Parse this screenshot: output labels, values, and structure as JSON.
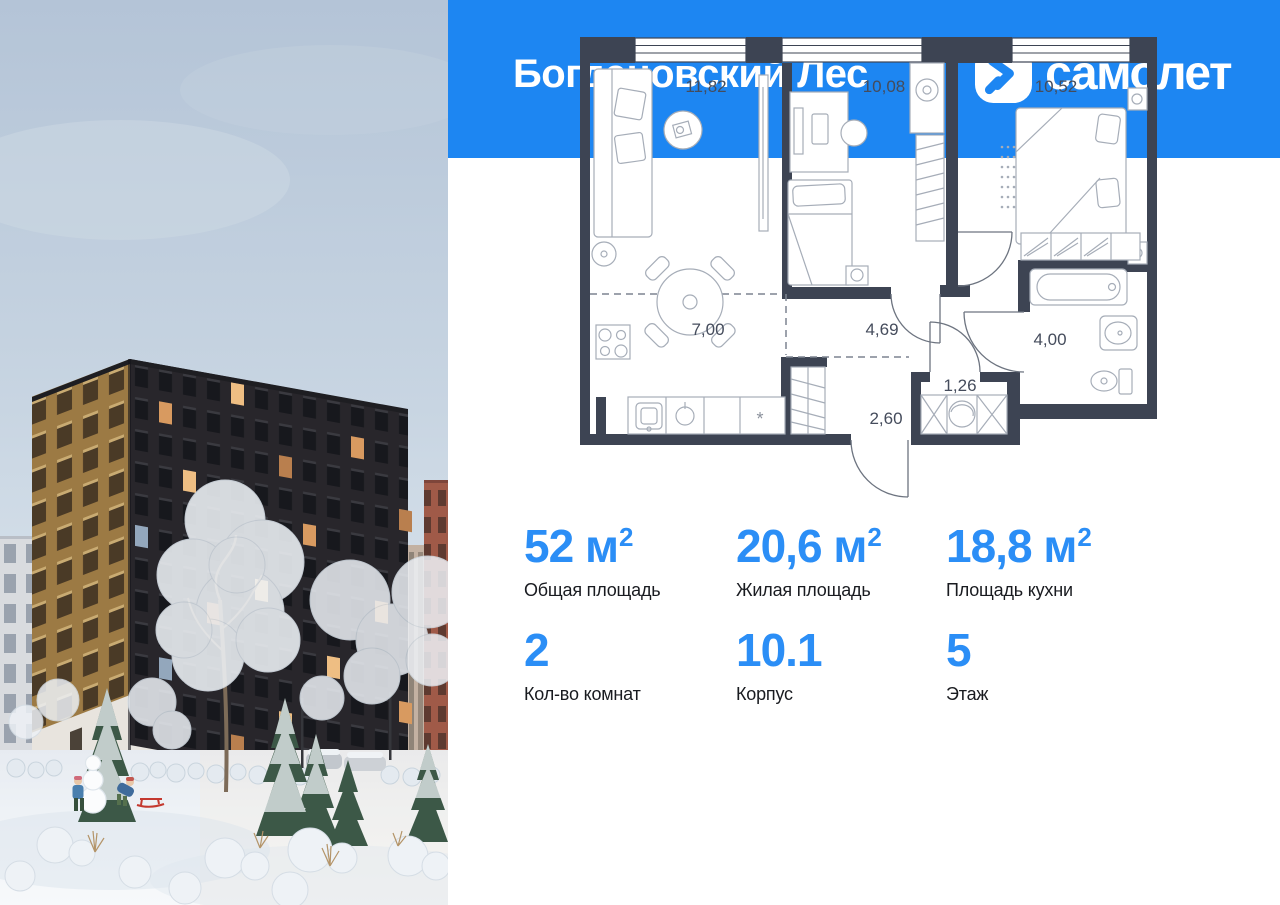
{
  "header": {
    "project_title": "Богдановский Лес",
    "brand": "самолет"
  },
  "floorplan": {
    "room_areas": {
      "living_room": "11,82",
      "bedroom": "10,08",
      "master_bedroom": "10,52",
      "kitchen": "7,00",
      "hallway": "4,69",
      "corridor": "2,60",
      "storage": "1,26",
      "bathroom": "4,00"
    }
  },
  "stats": {
    "row1": [
      {
        "value": "52",
        "unit": "м",
        "sup": "2",
        "label": "Общая площадь"
      },
      {
        "value": "20,6",
        "unit": "м",
        "sup": "2",
        "label": "Жилая площадь"
      },
      {
        "value": "18,8",
        "unit": "м",
        "sup": "2",
        "label": "Площадь кухни"
      }
    ],
    "row2": [
      {
        "value": "2",
        "label": "Кол-во комнат"
      },
      {
        "value": "10.1",
        "label": "Корпус"
      },
      {
        "value": "5",
        "label": "Этаж"
      }
    ]
  },
  "colors": {
    "brand_blue": "#1d86f2",
    "accent_number_blue": "#2b8ef6",
    "plan_wall": "#3d4453"
  }
}
